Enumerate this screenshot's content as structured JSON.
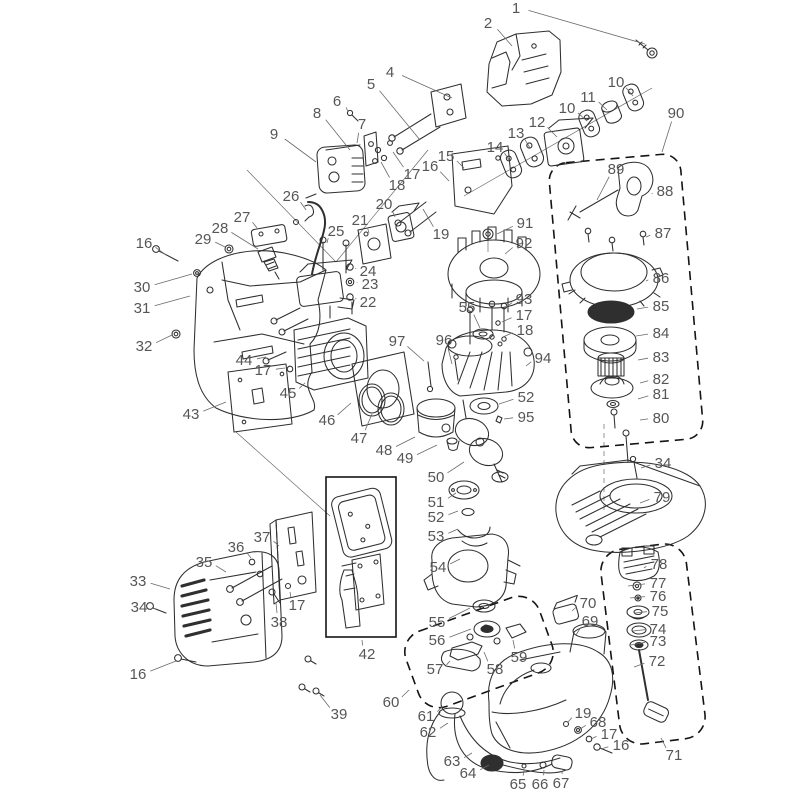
{
  "meta": {
    "description_not_rendered": "exploded parts diagram of a small two-stroke engine"
  },
  "colors": {
    "background": "#ffffff",
    "line": "#2f2f2f",
    "label": "#565656",
    "leader": "#6a6a6a",
    "dash": "#141414"
  },
  "labels": [
    {
      "n": "1",
      "x": 516,
      "y": 8,
      "lx": 645,
      "ly": 44
    },
    {
      "n": "2",
      "x": 488,
      "y": 23,
      "lx": 512,
      "ly": 46
    },
    {
      "n": "4",
      "x": 390,
      "y": 72,
      "lx": 452,
      "ly": 98
    },
    {
      "n": "5",
      "x": 371,
      "y": 84,
      "lx": 420,
      "ly": 140
    },
    {
      "n": "6",
      "x": 337,
      "y": 101,
      "lx": 348,
      "ly": 112
    },
    {
      "n": "8",
      "x": 317,
      "y": 113,
      "lx": 350,
      "ly": 150
    },
    {
      "n": "7",
      "x": 362,
      "y": 124,
      "lx": 357,
      "ly": 143
    },
    {
      "n": "9",
      "x": 274,
      "y": 134,
      "lx": 316,
      "ly": 162
    },
    {
      "n": "10",
      "x": 616,
      "y": 82,
      "lx": 633,
      "ly": 96
    },
    {
      "n": "11",
      "x": 588,
      "y": 97,
      "lx": 607,
      "ly": 110
    },
    {
      "n": "10",
      "x": 567,
      "y": 108,
      "lx": 587,
      "ly": 121
    },
    {
      "n": "12",
      "x": 537,
      "y": 122,
      "lx": 557,
      "ly": 137
    },
    {
      "n": "13",
      "x": 516,
      "y": 133,
      "lx": 530,
      "ly": 148
    },
    {
      "n": "14",
      "x": 495,
      "y": 147,
      "lx": 509,
      "ly": 160
    },
    {
      "n": "15",
      "x": 446,
      "y": 156,
      "lx": 464,
      "ly": 168
    },
    {
      "n": "16",
      "x": 430,
      "y": 166,
      "lx": 449,
      "ly": 181
    },
    {
      "n": "17",
      "x": 412,
      "y": 174,
      "lx": 393,
      "ly": 152
    },
    {
      "n": "18",
      "x": 397,
      "y": 185,
      "lx": 381,
      "ly": 162
    },
    {
      "n": "90",
      "x": 676,
      "y": 113,
      "lx": 662,
      "ly": 152
    },
    {
      "n": "26",
      "x": 291,
      "y": 196,
      "lx": 306,
      "ly": 210
    },
    {
      "n": "27",
      "x": 242,
      "y": 217,
      "lx": 257,
      "ly": 228
    },
    {
      "n": "20",
      "x": 384,
      "y": 204,
      "lx": 395,
      "ly": 217
    },
    {
      "n": "21",
      "x": 360,
      "y": 220,
      "lx": 369,
      "ly": 233
    },
    {
      "n": "25",
      "x": 336,
      "y": 231,
      "lx": 327,
      "ly": 243
    },
    {
      "n": "19",
      "x": 441,
      "y": 234,
      "lx": 423,
      "ly": 209
    },
    {
      "n": "28",
      "x": 220,
      "y": 228,
      "lx": 258,
      "ly": 249
    },
    {
      "n": "29",
      "x": 203,
      "y": 239,
      "lx": 225,
      "ly": 247
    },
    {
      "n": "16",
      "x": 144,
      "y": 243,
      "lx": 166,
      "ly": 255
    },
    {
      "n": "30",
      "x": 142,
      "y": 287,
      "lx": 192,
      "ly": 274
    },
    {
      "n": "31",
      "x": 142,
      "y": 308,
      "lx": 190,
      "ly": 296
    },
    {
      "n": "32",
      "x": 144,
      "y": 346,
      "lx": 172,
      "ly": 335
    },
    {
      "n": "24",
      "x": 368,
      "y": 271,
      "lx": 356,
      "ly": 268
    },
    {
      "n": "23",
      "x": 370,
      "y": 284,
      "lx": 357,
      "ly": 282
    },
    {
      "n": "22",
      "x": 368,
      "y": 302,
      "lx": 356,
      "ly": 298
    },
    {
      "n": "44",
      "x": 244,
      "y": 360,
      "lx": 266,
      "ly": 357
    },
    {
      "n": "17",
      "x": 263,
      "y": 370,
      "lx": 285,
      "ly": 368
    },
    {
      "n": "43",
      "x": 191,
      "y": 414,
      "lx": 226,
      "ly": 402
    },
    {
      "n": "45",
      "x": 288,
      "y": 393,
      "lx": 305,
      "ly": 383
    },
    {
      "n": "46",
      "x": 327,
      "y": 420,
      "lx": 351,
      "ly": 403
    },
    {
      "n": "47",
      "x": 359,
      "y": 438,
      "lx": 372,
      "ly": 414
    },
    {
      "n": "48",
      "x": 384,
      "y": 450,
      "lx": 415,
      "ly": 437
    },
    {
      "n": "49",
      "x": 405,
      "y": 458,
      "lx": 437,
      "ly": 445
    },
    {
      "n": "97",
      "x": 397,
      "y": 341,
      "lx": 424,
      "ly": 361
    },
    {
      "n": "96",
      "x": 444,
      "y": 340,
      "lx": 452,
      "ly": 364
    },
    {
      "n": "91",
      "x": 525,
      "y": 223,
      "lx": 497,
      "ly": 234
    },
    {
      "n": "92",
      "x": 524,
      "y": 243,
      "lx": 505,
      "ly": 254
    },
    {
      "n": "55",
      "x": 467,
      "y": 307,
      "lx": 480,
      "ly": 328
    },
    {
      "n": "93",
      "x": 524,
      "y": 299,
      "lx": 506,
      "ly": 307
    },
    {
      "n": "17",
      "x": 524,
      "y": 315,
      "lx": 502,
      "ly": 322
    },
    {
      "n": "18",
      "x": 525,
      "y": 330,
      "lx": 503,
      "ly": 337
    },
    {
      "n": "94",
      "x": 543,
      "y": 358,
      "lx": 526,
      "ly": 366
    },
    {
      "n": "52",
      "x": 526,
      "y": 397,
      "lx": 499,
      "ly": 404
    },
    {
      "n": "95",
      "x": 526,
      "y": 417,
      "lx": 504,
      "ly": 419
    },
    {
      "n": "34",
      "x": 663,
      "y": 463,
      "lx": 641,
      "ly": 468
    },
    {
      "n": "79",
      "x": 662,
      "y": 497,
      "lx": 640,
      "ly": 503
    },
    {
      "n": "50",
      "x": 436,
      "y": 477,
      "lx": 464,
      "ly": 462
    },
    {
      "n": "51",
      "x": 436,
      "y": 502,
      "lx": 456,
      "ly": 493
    },
    {
      "n": "52",
      "x": 436,
      "y": 517,
      "lx": 458,
      "ly": 511
    },
    {
      "n": "53",
      "x": 436,
      "y": 536,
      "lx": 458,
      "ly": 529
    },
    {
      "n": "54",
      "x": 438,
      "y": 567,
      "lx": 460,
      "ly": 559
    },
    {
      "n": "55",
      "x": 437,
      "y": 622,
      "lx": 470,
      "ly": 608
    },
    {
      "n": "56",
      "x": 437,
      "y": 640,
      "lx": 471,
      "ly": 629
    },
    {
      "n": "57",
      "x": 435,
      "y": 669,
      "lx": 450,
      "ly": 661
    },
    {
      "n": "58",
      "x": 495,
      "y": 669,
      "lx": 484,
      "ly": 652
    },
    {
      "n": "59",
      "x": 519,
      "y": 657,
      "lx": 513,
      "ly": 640
    },
    {
      "n": "60",
      "x": 391,
      "y": 702,
      "lx": 409,
      "ly": 690
    },
    {
      "n": "61",
      "x": 426,
      "y": 716,
      "lx": 442,
      "ly": 707
    },
    {
      "n": "62",
      "x": 428,
      "y": 732,
      "lx": 448,
      "ly": 723
    },
    {
      "n": "63",
      "x": 452,
      "y": 761,
      "lx": 472,
      "ly": 753
    },
    {
      "n": "64",
      "x": 468,
      "y": 773,
      "lx": 489,
      "ly": 765
    },
    {
      "n": "65",
      "x": 518,
      "y": 784,
      "lx": 524,
      "ly": 770
    },
    {
      "n": "66",
      "x": 540,
      "y": 784,
      "lx": 544,
      "ly": 770
    },
    {
      "n": "67",
      "x": 561,
      "y": 783,
      "lx": 562,
      "ly": 771
    },
    {
      "n": "19",
      "x": 583,
      "y": 713,
      "lx": 568,
      "ly": 722
    },
    {
      "n": "68",
      "x": 598,
      "y": 722,
      "lx": 580,
      "ly": 729
    },
    {
      "n": "17",
      "x": 609,
      "y": 734,
      "lx": 591,
      "ly": 739
    },
    {
      "n": "16",
      "x": 621,
      "y": 745,
      "lx": 601,
      "ly": 749
    },
    {
      "n": "69",
      "x": 590,
      "y": 621,
      "lx": 576,
      "ly": 635
    },
    {
      "n": "70",
      "x": 588,
      "y": 603,
      "lx": 572,
      "ly": 611
    },
    {
      "n": "71",
      "x": 674,
      "y": 755,
      "lx": 661,
      "ly": 738
    },
    {
      "n": "72",
      "x": 657,
      "y": 661,
      "lx": 634,
      "ly": 667
    },
    {
      "n": "73",
      "x": 658,
      "y": 641,
      "lx": 631,
      "ly": 645
    },
    {
      "n": "74",
      "x": 658,
      "y": 629,
      "lx": 633,
      "ly": 631
    },
    {
      "n": "75",
      "x": 660,
      "y": 611,
      "lx": 635,
      "ly": 613
    },
    {
      "n": "76",
      "x": 658,
      "y": 596,
      "lx": 630,
      "ly": 598
    },
    {
      "n": "77",
      "x": 658,
      "y": 583,
      "lx": 628,
      "ly": 586
    },
    {
      "n": "78",
      "x": 659,
      "y": 564,
      "lx": 644,
      "ly": 568
    },
    {
      "n": "80",
      "x": 661,
      "y": 418,
      "lx": 640,
      "ly": 420
    },
    {
      "n": "81",
      "x": 661,
      "y": 394,
      "lx": 638,
      "ly": 399
    },
    {
      "n": "82",
      "x": 661,
      "y": 379,
      "lx": 640,
      "ly": 383
    },
    {
      "n": "83",
      "x": 661,
      "y": 357,
      "lx": 638,
      "ly": 360
    },
    {
      "n": "84",
      "x": 661,
      "y": 333,
      "lx": 636,
      "ly": 336
    },
    {
      "n": "85",
      "x": 661,
      "y": 306,
      "lx": 637,
      "ly": 309
    },
    {
      "n": "86",
      "x": 661,
      "y": 278,
      "lx": 646,
      "ly": 281
    },
    {
      "n": "87",
      "x": 663,
      "y": 233,
      "lx": 646,
      "ly": 237
    },
    {
      "n": "88",
      "x": 665,
      "y": 191,
      "lx": 652,
      "ly": 194
    },
    {
      "n": "89",
      "x": 616,
      "y": 169,
      "lx": 597,
      "ly": 200
    },
    {
      "n": "33",
      "x": 138,
      "y": 581,
      "lx": 170,
      "ly": 589
    },
    {
      "n": "34",
      "x": 139,
      "y": 607,
      "lx": 156,
      "ly": 609
    },
    {
      "n": "35",
      "x": 204,
      "y": 562,
      "lx": 226,
      "ly": 572
    },
    {
      "n": "36",
      "x": 236,
      "y": 547,
      "lx": 251,
      "ly": 558
    },
    {
      "n": "37",
      "x": 262,
      "y": 537,
      "lx": 279,
      "ly": 546
    },
    {
      "n": "38",
      "x": 279,
      "y": 622,
      "lx": 276,
      "ly": 603
    },
    {
      "n": "17",
      "x": 297,
      "y": 605,
      "lx": 290,
      "ly": 592
    },
    {
      "n": "16",
      "x": 138,
      "y": 674,
      "lx": 176,
      "ly": 661
    },
    {
      "n": "39",
      "x": 339,
      "y": 714,
      "lx": 320,
      "ly": 695
    },
    {
      "n": "42",
      "x": 367,
      "y": 654,
      "lx": 362,
      "ly": 640
    }
  ]
}
